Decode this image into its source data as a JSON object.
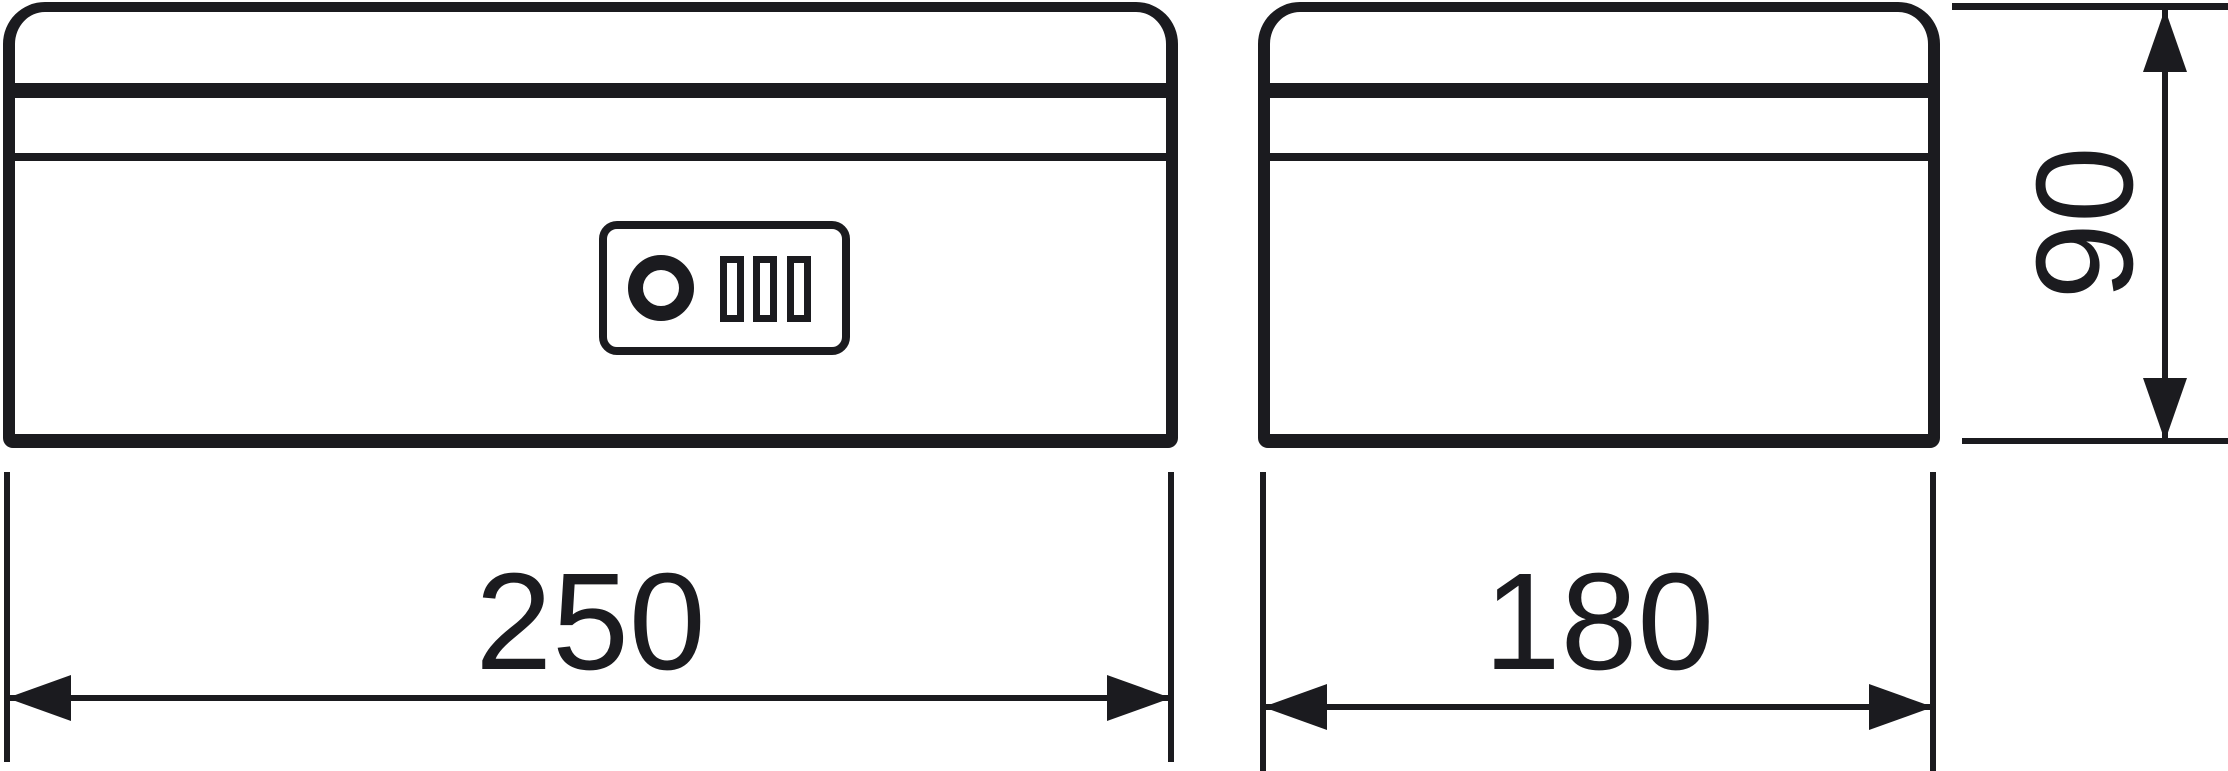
{
  "meta": {
    "background_color": "#ffffff",
    "ink_color": "#1b1b1f",
    "kind": "two-view technical line drawing of a lockable cash box"
  },
  "views": {
    "front": {
      "name": "front-view"
    },
    "side": {
      "name": "side-view"
    }
  },
  "lock": {
    "keyhole_icon": "keyhole-icon",
    "dials_icon": "combination-dials-icon",
    "dial_count": 3
  },
  "dimensions": {
    "width": {
      "value": "250"
    },
    "depth": {
      "value": "180"
    },
    "height": {
      "value": "90"
    }
  }
}
